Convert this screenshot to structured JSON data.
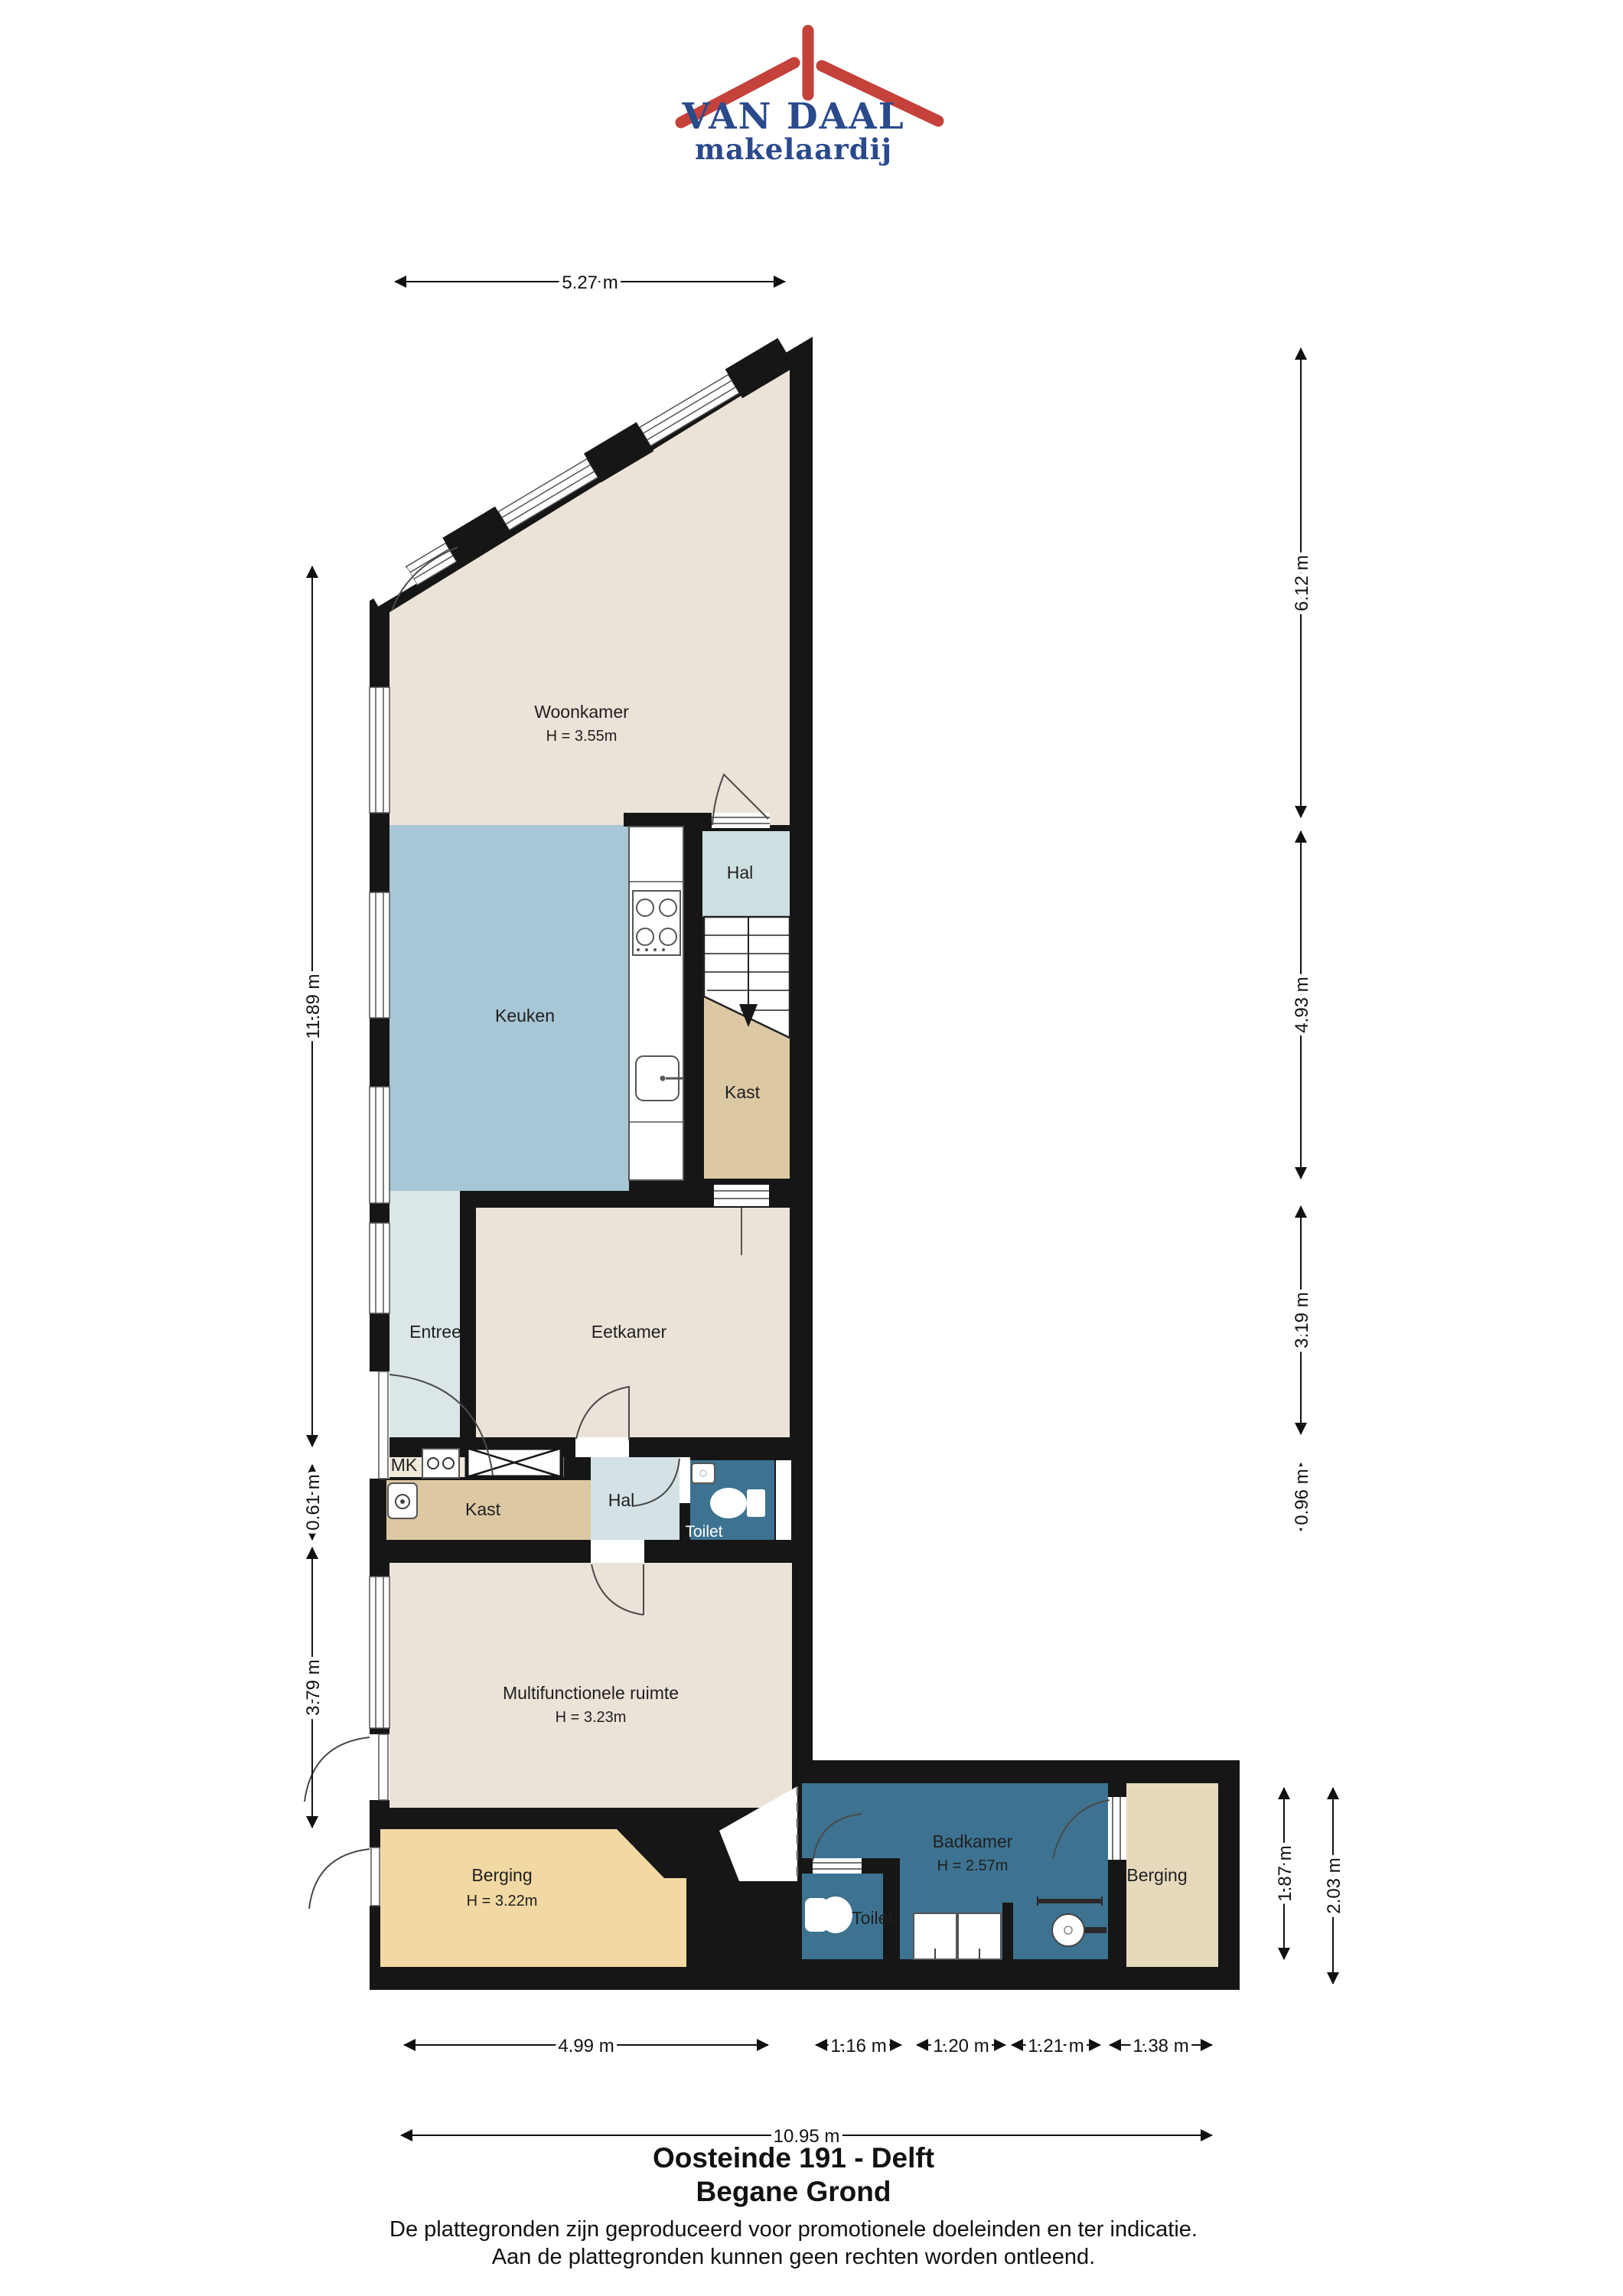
{
  "logo": {
    "line1": "VAN DAAL",
    "line2": "makelaardij"
  },
  "rooms": {
    "woonkamer": {
      "label": "Woonkamer",
      "height": "H = 3.55m"
    },
    "keuken": {
      "label": "Keuken"
    },
    "hal_boven": {
      "label": "Hal"
    },
    "kast_boven": {
      "label": "Kast"
    },
    "entree": {
      "label": "Entree"
    },
    "eetkamer": {
      "label": "Eetkamer"
    },
    "mk": {
      "label": "MK"
    },
    "kast_midden": {
      "label": "Kast"
    },
    "hal_midden": {
      "label": "Hal"
    },
    "toilet_midden": {
      "label": "Toilet"
    },
    "multifunctionele_ruimte": {
      "label": "Multifunctionele ruimte",
      "height": "H = 3.23m"
    },
    "berging_links": {
      "label": "Berging",
      "height": "H = 3.22m"
    },
    "toilet_achter": {
      "label": "Toilet"
    },
    "badkamer": {
      "label": "Badkamer",
      "height": "H = 2.57m"
    },
    "berging_rechts": {
      "label": "Berging"
    }
  },
  "dims": {
    "top": "5.27 m",
    "left": [
      "11.89 m",
      "0.61 m",
      "3.79 m"
    ],
    "right": [
      "6.12 m",
      "4.93 m",
      "3.19 m",
      "0.96 m"
    ],
    "right_rear": [
      "1.87 m",
      "2.03 m"
    ],
    "bottom": [
      "4.99 m",
      "1.16 m",
      "1.20 m",
      "1.21 m",
      "1.38 m"
    ],
    "bottom_total": "10.95 m"
  },
  "title": {
    "line1": "Oosteinde 191 - Delft",
    "line2": "Begane Grond"
  },
  "disclaimer": {
    "line1": "De plattegronden zijn geproduceerd voor promotionele doeleinden en ter indicatie.",
    "line2": "Aan de plattegronden kunnen geen rechten worden ontleend."
  },
  "colors": {
    "brand_blue": "#2a4a8c",
    "brand_red": "#c4423a",
    "wall": "#161616",
    "living_beige": "#ece3d8",
    "kitchen_blue": "#a7c6d6",
    "hall_blue": "#d5e2e5",
    "closet_tan": "#dcc9a4",
    "sanitary_teal": "#3d7391",
    "storage_orange": "#f2d8a2",
    "storage_tan": "#e6d9bc"
  }
}
